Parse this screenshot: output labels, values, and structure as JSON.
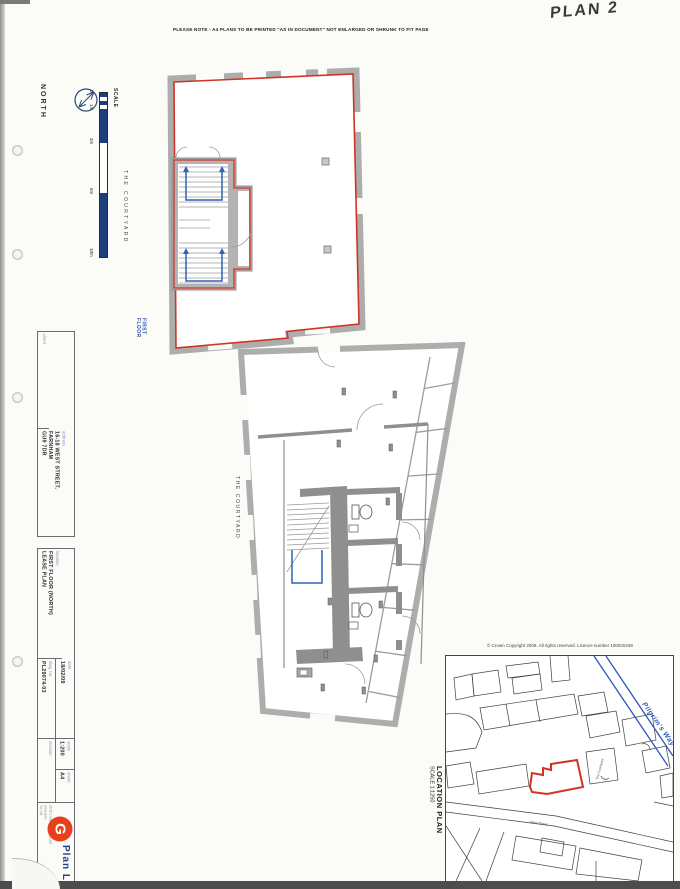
{
  "page": {
    "handwritten_label": "PLAN 2",
    "print_note": "PLEASE NOTE - A4 PLANS TO BE PRINTED \"AS IN DOCUMENT\" NOT ENLARGED OR SHRUNK TO FIT PAGE"
  },
  "compass": {
    "label": "NORTH"
  },
  "scale_bar": {
    "label": "SCALE",
    "ticks": [
      "0",
      "1m",
      "3m",
      "6m",
      "10m"
    ]
  },
  "plan_labels": {
    "courtyard_upper": "THE COURTYARD",
    "courtyard_lower": "THE COURTYARD",
    "first_floor": "FIRST\nFLOOR"
  },
  "title_block": {
    "client_label": "client",
    "address_label": "address",
    "address_value": "16-18 WEST STREET,\nFARNHAM\nGU9 7DR",
    "location_label": "location",
    "location_value": "FIRST FLOOR (NORTH)\nLEASE PLAN",
    "date_label": "date",
    "date_value": "18/02/09",
    "dwg_label": "dwg. no.",
    "dwg_value": "PL29074-03",
    "scale_label": "scale",
    "scale_value": "1:200",
    "sheet_label": "sheet",
    "sheet_value": "A4",
    "revision_label": "revision"
  },
  "logo": {
    "mark": "G",
    "brand": "Plan L",
    "address_line": "28-35 Lordship Lane | Lond",
    "web_line": "www.plan-",
    "tel_line": "Tel | 08"
  },
  "location_plan": {
    "title": "LOCATION PLAN",
    "scale": "SCALE 1:1250",
    "copyright": "© Crown Copyright 2008. All rights reserved. Licence number 100020449",
    "road_label": "Pilgrim's Way",
    "street_label": "West Street",
    "courtyard_label": "The Courtyard"
  },
  "colors": {
    "lease_line": "#cf3425",
    "stair_blue": "#2e64b5",
    "scalebar_navy": "#1e3e7c",
    "logo_red": "#e8401c",
    "road_blue": "#2b59b5"
  }
}
